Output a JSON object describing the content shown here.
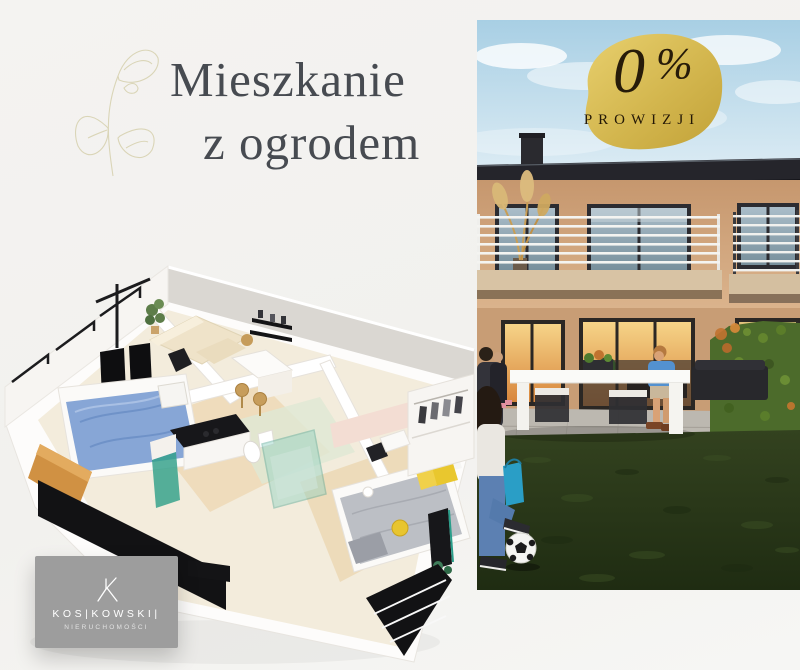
{
  "page": {
    "background": "#f2f1ef"
  },
  "title": {
    "line1": "Mieszkanie",
    "line2": "z ogrodem",
    "color": "#474b51"
  },
  "badge": {
    "amount": "0",
    "percent": "%",
    "label": "PROWIZJI",
    "background": "#d3b64e",
    "text_color": "#271b09"
  },
  "logo": {
    "name": "KOS|KOWSKI|",
    "subtitle": "NIERUCHOMOŚCI",
    "background": "#9d9d9d",
    "text_color": "#ffffff"
  },
  "photo": {
    "colors": {
      "sky": "#a8cfe4",
      "roof": "#25252b",
      "facade": "#c89d77",
      "grass": "#2c3a1d",
      "hedge": "#4c6b2b",
      "window_glow": "#e8a95c"
    }
  },
  "floorplan": {
    "colors": {
      "walls": "#fbfaf8",
      "floor": "#f3ecdc",
      "bed_blue": "#87a6d6",
      "sofa_cream": "#efe3c9",
      "accent_yellow": "#e9c72e",
      "wood_orange": "#cf9140",
      "glass_teal": "#31a089",
      "panel_black": "#121214"
    }
  }
}
